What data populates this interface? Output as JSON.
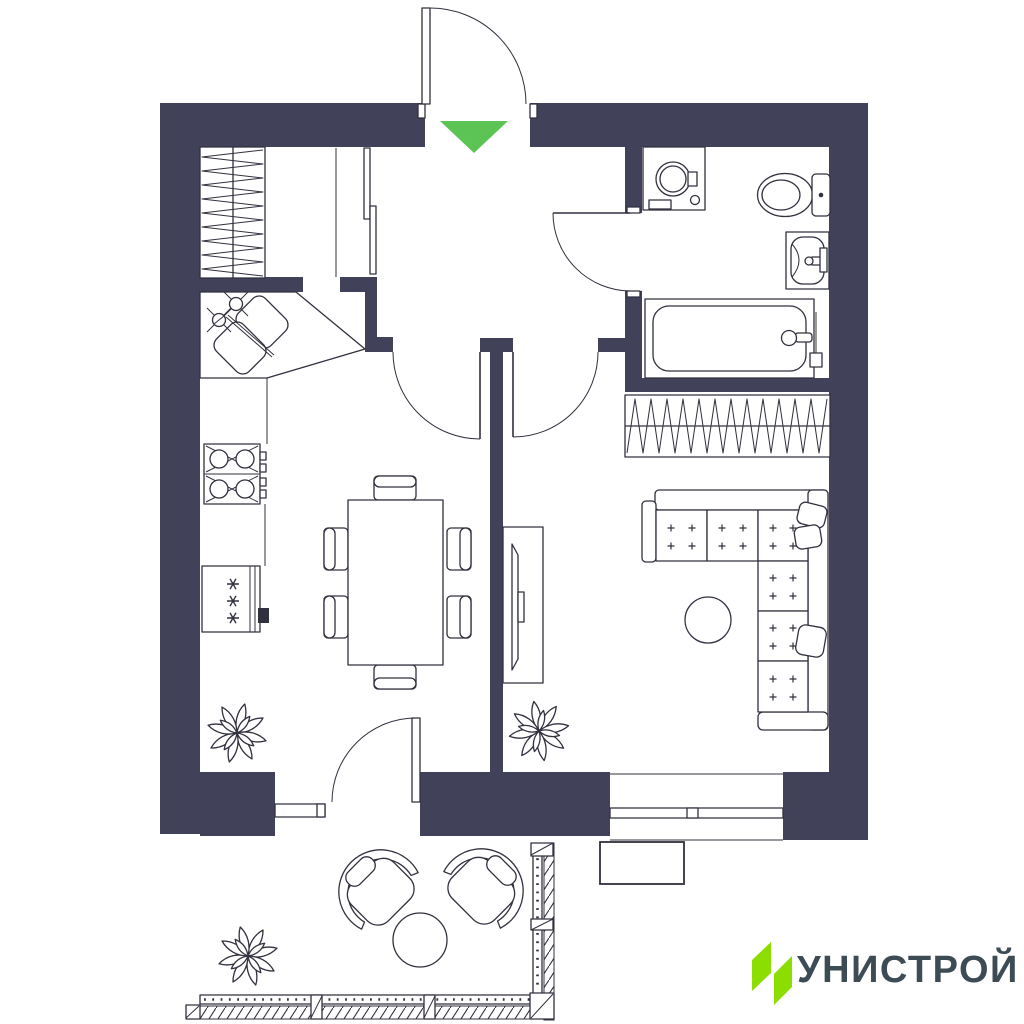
{
  "app": {
    "type": "apartment-floor-plan"
  },
  "colors": {
    "background": "#ffffff",
    "wall": "#42415a",
    "line": "#31303e",
    "entrance_arrow": "#5cc455",
    "logo_mark": "#8cdd00",
    "logo_text": "#3d4b55"
  },
  "logo": {
    "text": "УНИСТРОЙ"
  },
  "entrance": {
    "marker": "green-arrow-down-icon"
  },
  "furniture_icons": [
    "entry-door-icon",
    "sliding-wardrobe-icon",
    "coat-closet-hatch-icon",
    "corner-sink-icon",
    "gas-stove-icon",
    "refrigerator-icon",
    "dining-table-icon",
    "dining-chair-icon",
    "interior-door-icon",
    "washing-machine-icon",
    "toilet-icon",
    "wash-basin-icon",
    "bathtub-icon",
    "built-in-wardrobe-hatch-icon",
    "corner-sofa-icon",
    "throw-pillow-icon",
    "coffee-table-icon",
    "tv-stand-icon",
    "potted-plant-icon",
    "balcony-door-icon",
    "armchair-icon",
    "balcony-table-icon",
    "balcony-railing-icon",
    "window-icon",
    "ac-unit-icon"
  ]
}
